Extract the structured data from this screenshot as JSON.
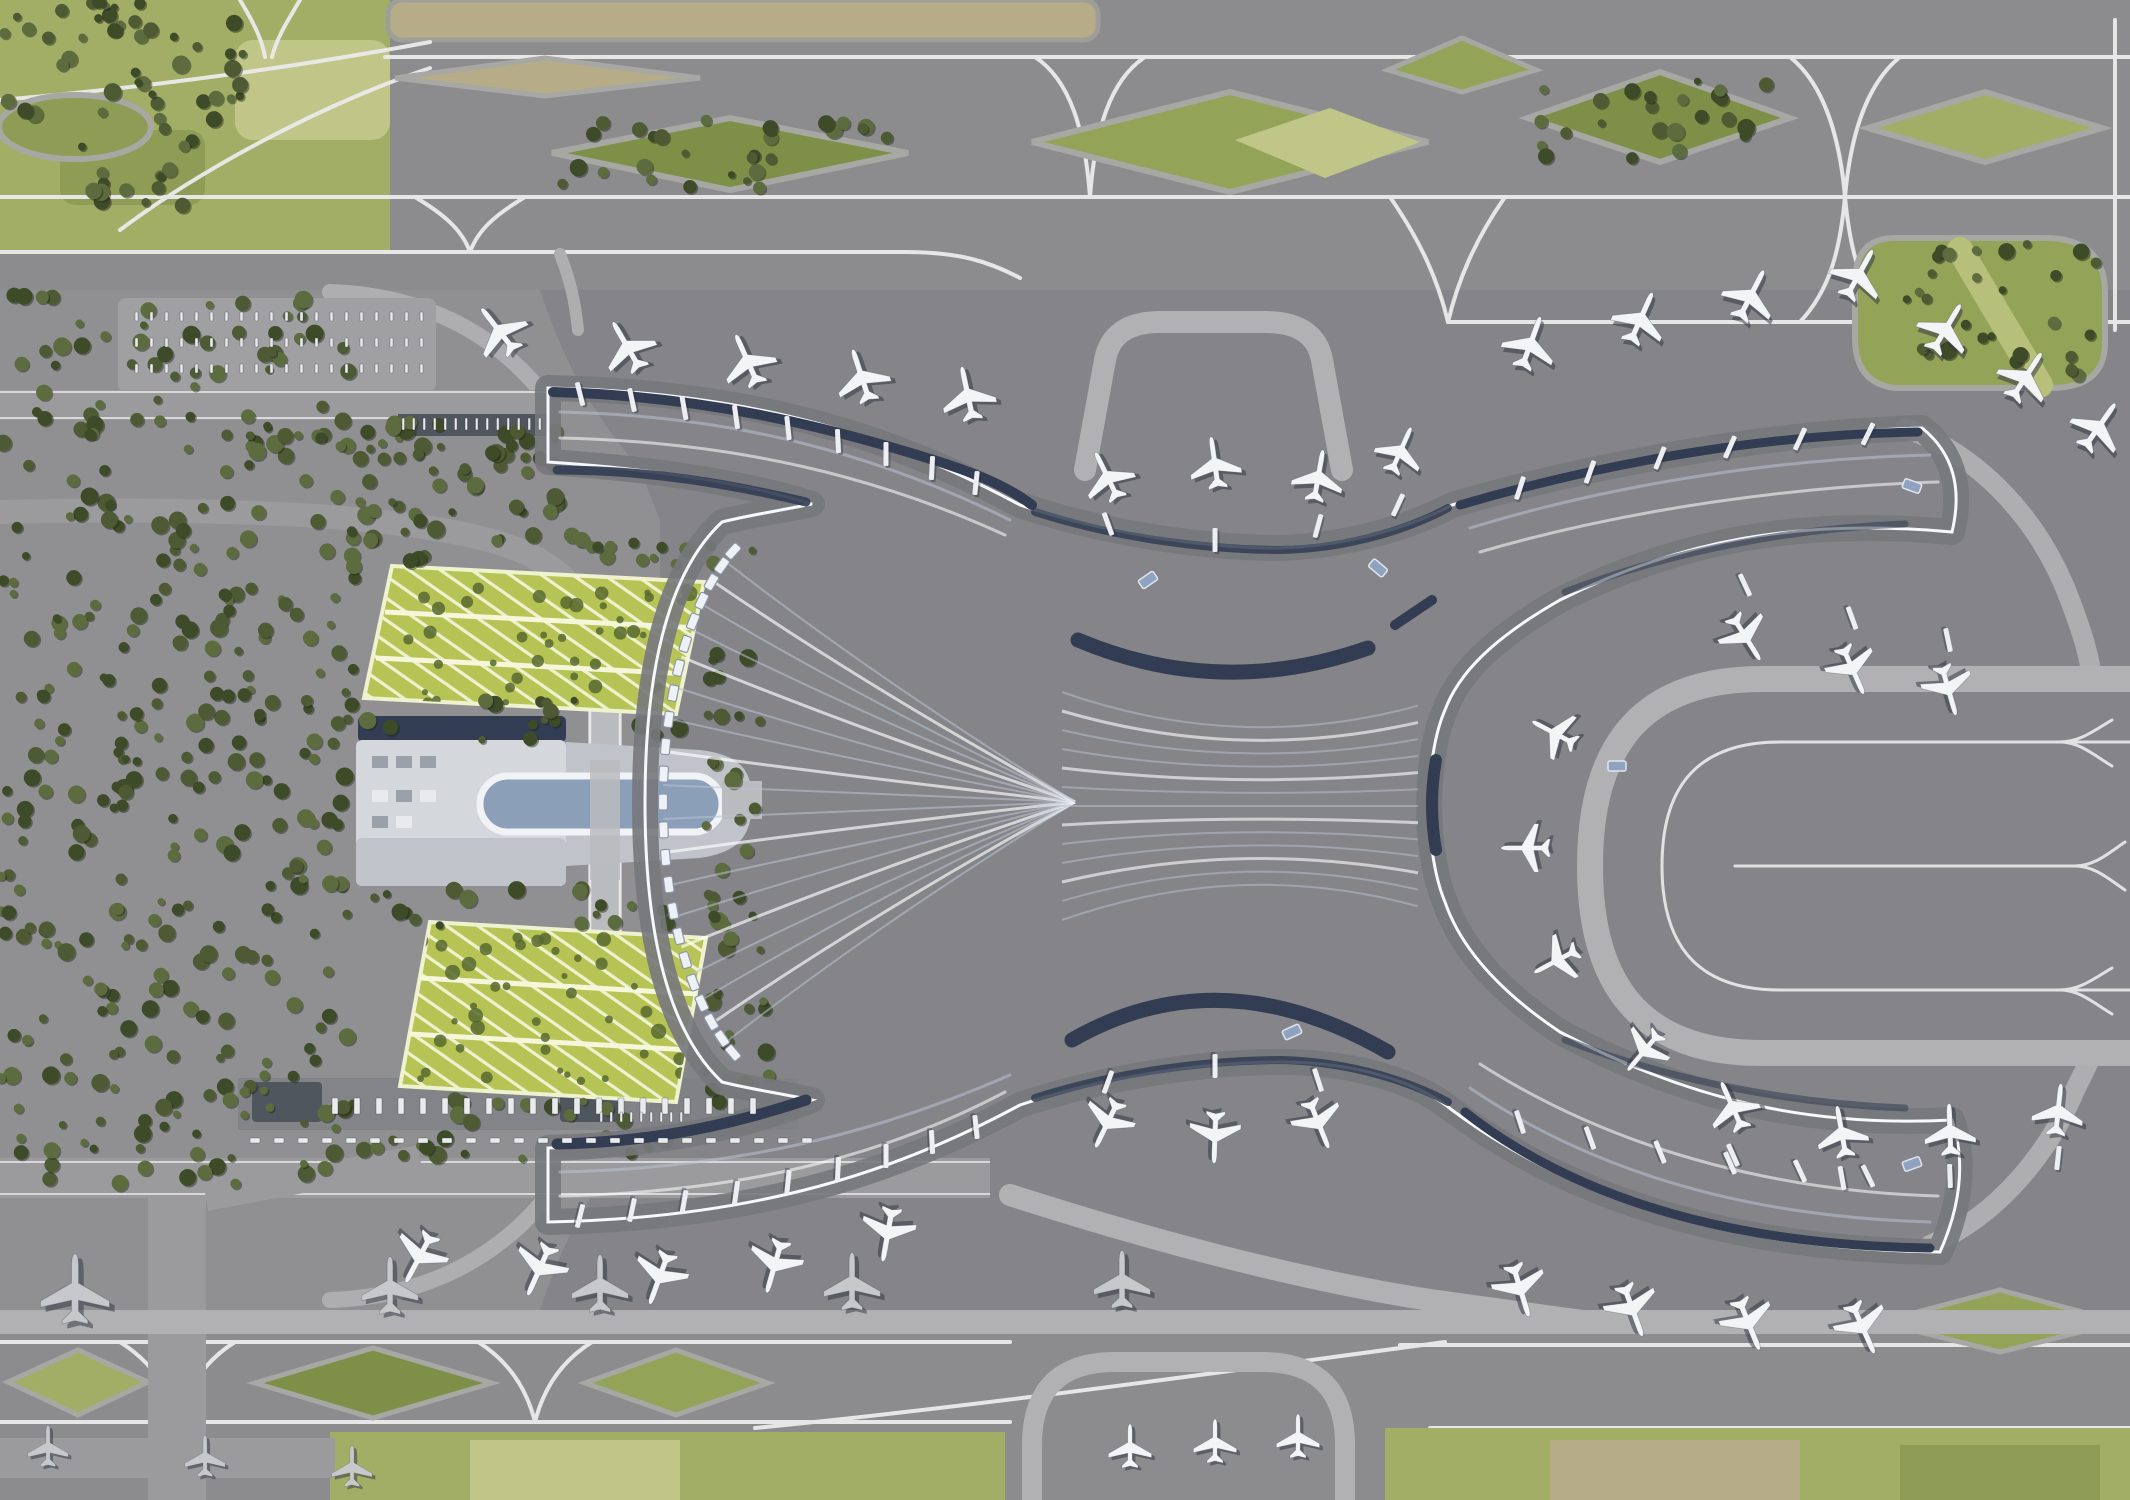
{
  "meta": {
    "description": "Aerial 3D architectural rendering of an airport: X-shaped terminal with flowing white roof, four curved piers lined with aircraft, east taxiway loop, north and south taxiway grids with green infield islands, landside forest, two green-roof parking garages and a ground transport center with an oval canopy",
    "view": "top-down render",
    "width": 2130,
    "height": 1500
  },
  "palette": {
    "ground": "#8d8d90",
    "ground_top": "#8c8c8f",
    "apron": "#858589",
    "apron_dark": "#7d7d81",
    "landside": "#909093",
    "line_white": "#ebebec",
    "taxiway_light": "#aeaeb0",
    "band_wide": "#b1b1b3",
    "field": "#a2ad66",
    "field_light": "#c0c688",
    "field_dark": "#8f9c55",
    "lens_green": "#93a358",
    "lens_dark": "#7e9048",
    "beige": "#b6ad88",
    "tree": "#4d5a33",
    "tree_dark": "#3e4b28",
    "tree_light": "#5d6c3f",
    "garage": "#b6c456",
    "garage_line": "#eef2cf",
    "garage_cell": "#57682f",
    "roof": "#dfe4ee",
    "roof_hi": "#f1f3f8",
    "roof_shade": "#b9c2d4",
    "facade": "#323c52",
    "service": "#77787c",
    "glass": "#8fa3c0",
    "oval": "#8ba0b8",
    "gtc_roof": "#d4d7dc",
    "gtc_mid": "#c0c4ca",
    "road": "#9b9b9e",
    "viaduct": "#babbbe",
    "shelter": "#50565e",
    "plane_white": "#f3f4f6",
    "plane_gray": "#c6c8cb",
    "plane_shadow": "rgba(45,50,62,0.5)",
    "terminal_shadow": "rgba(40,45,60,0.28)"
  },
  "aircraft": [
    [
      500,
      332,
      -38,
      1,
      "w"
    ],
    [
      628,
      348,
      -30,
      1,
      "w"
    ],
    [
      748,
      362,
      -24,
      1,
      "w"
    ],
    [
      862,
      378,
      -18,
      1,
      "w"
    ],
    [
      968,
      396,
      -12,
      1,
      "w"
    ],
    [
      1108,
      478,
      -26,
      0.95,
      "w"
    ],
    [
      1215,
      465,
      -8,
      0.95,
      "w"
    ],
    [
      1318,
      478,
      10,
      0.95,
      "w"
    ],
    [
      1400,
      452,
      24,
      0.9,
      "w"
    ],
    [
      1530,
      345,
      20,
      1,
      "w"
    ],
    [
      1640,
      320,
      24,
      1,
      "w"
    ],
    [
      1750,
      297,
      27,
      1,
      "w"
    ],
    [
      1858,
      276,
      29,
      1,
      "w"
    ],
    [
      1945,
      330,
      31,
      1,
      "w"
    ],
    [
      2025,
      378,
      33,
      1,
      "w"
    ],
    [
      2098,
      428,
      35,
      1,
      "w"
    ],
    [
      1745,
      636,
      148,
      0.95,
      "w"
    ],
    [
      1852,
      668,
      156,
      0.95,
      "w"
    ],
    [
      1948,
      688,
      164,
      0.95,
      "w"
    ],
    [
      1556,
      734,
      -62,
      0.9,
      "w"
    ],
    [
      1528,
      848,
      -90,
      0.9,
      "w"
    ],
    [
      1558,
      960,
      -118,
      0.9,
      "w"
    ],
    [
      1645,
      1050,
      -140,
      0.9,
      "w"
    ],
    [
      1733,
      1108,
      -24,
      0.95,
      "w"
    ],
    [
      1842,
      1134,
      -10,
      0.95,
      "w"
    ],
    [
      1950,
      1132,
      -2,
      0.95,
      "w"
    ],
    [
      2058,
      1112,
      6,
      0.95,
      "w"
    ],
    [
      1108,
      1122,
      206,
      0.95,
      "w"
    ],
    [
      1215,
      1135,
      182,
      0.95,
      "w"
    ],
    [
      1318,
      1122,
      158,
      0.95,
      "w"
    ],
    [
      420,
      1256,
      208,
      1,
      "w"
    ],
    [
      540,
      1268,
      204,
      1,
      "w"
    ],
    [
      660,
      1276,
      200,
      1,
      "w"
    ],
    [
      775,
      1264,
      196,
      1,
      "w"
    ],
    [
      888,
      1232,
      190,
      1,
      "w"
    ],
    [
      1520,
      1288,
      163,
      1,
      "w"
    ],
    [
      1632,
      1308,
      160,
      1,
      "w"
    ],
    [
      1748,
      1322,
      158,
      1,
      "w"
    ],
    [
      1862,
      1326,
      156,
      1,
      "w"
    ],
    [
      75,
      1292,
      0,
      1.28,
      "g"
    ],
    [
      390,
      1288,
      0,
      1.05,
      "g"
    ],
    [
      600,
      1286,
      0,
      1.05,
      "g"
    ],
    [
      852,
      1284,
      0,
      1.05,
      "g"
    ],
    [
      1122,
      1282,
      0,
      1.05,
      "g"
    ],
    [
      1130,
      1448,
      0,
      0.8,
      "w"
    ],
    [
      1215,
      1443,
      0,
      0.8,
      "w"
    ],
    [
      1298,
      1438,
      0,
      0.8,
      "w"
    ],
    [
      48,
      1448,
      0,
      0.75,
      "g"
    ],
    [
      205,
      1458,
      0,
      0.75,
      "g"
    ],
    [
      352,
      1468,
      0,
      0.75,
      "g"
    ]
  ],
  "jet_bridges": [
    [
      580,
      394,
      -14
    ],
    [
      632,
      400,
      -12
    ],
    [
      684,
      408,
      -10
    ],
    [
      736,
      417,
      -8
    ],
    [
      788,
      428,
      -6
    ],
    [
      838,
      441,
      -3
    ],
    [
      886,
      454,
      0
    ],
    [
      932,
      468,
      3
    ],
    [
      976,
      483,
      6
    ],
    [
      1108,
      524,
      -20
    ],
    [
      1215,
      540,
      0
    ],
    [
      1318,
      526,
      15
    ],
    [
      1398,
      505,
      25
    ],
    [
      1520,
      488,
      18
    ],
    [
      1590,
      472,
      20
    ],
    [
      1660,
      458,
      22
    ],
    [
      1730,
      447,
      24
    ],
    [
      1800,
      439,
      25
    ],
    [
      1868,
      434,
      26
    ],
    [
      1745,
      585,
      155
    ],
    [
      1852,
      618,
      160
    ],
    [
      1948,
      640,
      168
    ],
    [
      1733,
      1155,
      -24
    ],
    [
      1842,
      1178,
      -10
    ],
    [
      1950,
      1176,
      -2
    ],
    [
      2058,
      1158,
      6
    ],
    [
      1108,
      1082,
      200
    ],
    [
      1215,
      1066,
      180
    ],
    [
      1318,
      1080,
      162
    ],
    [
      580,
      1216,
      194
    ],
    [
      632,
      1210,
      192
    ],
    [
      684,
      1202,
      190
    ],
    [
      736,
      1193,
      188
    ],
    [
      788,
      1182,
      186
    ],
    [
      838,
      1169,
      183
    ],
    [
      886,
      1156,
      180
    ],
    [
      932,
      1142,
      177
    ],
    [
      976,
      1127,
      174
    ],
    [
      1520,
      1122,
      162
    ],
    [
      1590,
      1138,
      160
    ],
    [
      1660,
      1152,
      158
    ],
    [
      1730,
      1163,
      156
    ],
    [
      1800,
      1171,
      155
    ],
    [
      1868,
      1176,
      154
    ]
  ],
  "glass_bits": [
    [
      1378,
      568,
      40
    ],
    [
      1148,
      580,
      -35
    ],
    [
      1292,
      1032,
      -25
    ],
    [
      1912,
      486,
      20
    ],
    [
      1912,
      1164,
      -20
    ],
    [
      1617,
      766,
      0
    ]
  ],
  "tree_clusters": [
    [
      0,
      0,
      245,
      120,
      45
    ],
    [
      60,
      128,
      150,
      80,
      16
    ],
    [
      0,
      290,
      350,
      145,
      55
    ],
    [
      0,
      430,
      355,
      650,
      260
    ],
    [
      360,
      430,
      200,
      110,
      40
    ],
    [
      240,
      418,
      320,
      55,
      26
    ],
    [
      10,
      1075,
      340,
      110,
      48
    ],
    [
      352,
      530,
      370,
      42,
      24
    ],
    [
      352,
      700,
      370,
      40,
      20
    ],
    [
      340,
      888,
      380,
      38,
      20
    ],
    [
      352,
      1090,
      360,
      70,
      28
    ],
    [
      700,
      545,
      70,
      560,
      40
    ],
    [
      560,
      120,
      340,
      68,
      28
    ],
    [
      1535,
      80,
      250,
      80,
      24
    ],
    [
      1900,
      235,
      205,
      150,
      32
    ]
  ],
  "garage_blobs": [
    [
      400,
      575,
      290,
      130,
      40
    ],
    [
      415,
      935,
      280,
      155,
      40
    ]
  ],
  "dash_rows": [
    {
      "x": 332,
      "y": 1098,
      "count": 20,
      "step": 22,
      "w": 6,
      "h": 16
    },
    {
      "x": 250,
      "y": 1138,
      "count": 24,
      "step": 24,
      "w": 10,
      "h": 5
    },
    {
      "x": 135,
      "y": 312,
      "count": 20,
      "step": 15,
      "w": 3,
      "h": 9
    },
    {
      "x": 135,
      "y": 338,
      "count": 20,
      "step": 15,
      "w": 3,
      "h": 9
    },
    {
      "x": 135,
      "y": 364,
      "count": 20,
      "step": 15,
      "w": 3,
      "h": 9
    },
    {
      "x": 402,
      "y": 418,
      "count": 14,
      "step": 10.5,
      "w": 2.5,
      "h": 12
    },
    {
      "x": 600,
      "y": 1112,
      "count": 9,
      "step": 10,
      "w": 2.5,
      "h": 10
    }
  ],
  "fan": {
    "cx": 795,
    "cy": 802,
    "rx": 132,
    "ry": 284,
    "t0": 118,
    "t1": 242,
    "tabs": 22,
    "hub_x": 1075,
    "hub_y": 802,
    "pleats": 18
  },
  "waist_streaks": {
    "x0": 1062,
    "x1": 1418,
    "y0": 692,
    "step": 19,
    "count": 13,
    "cy": 806
  }
}
